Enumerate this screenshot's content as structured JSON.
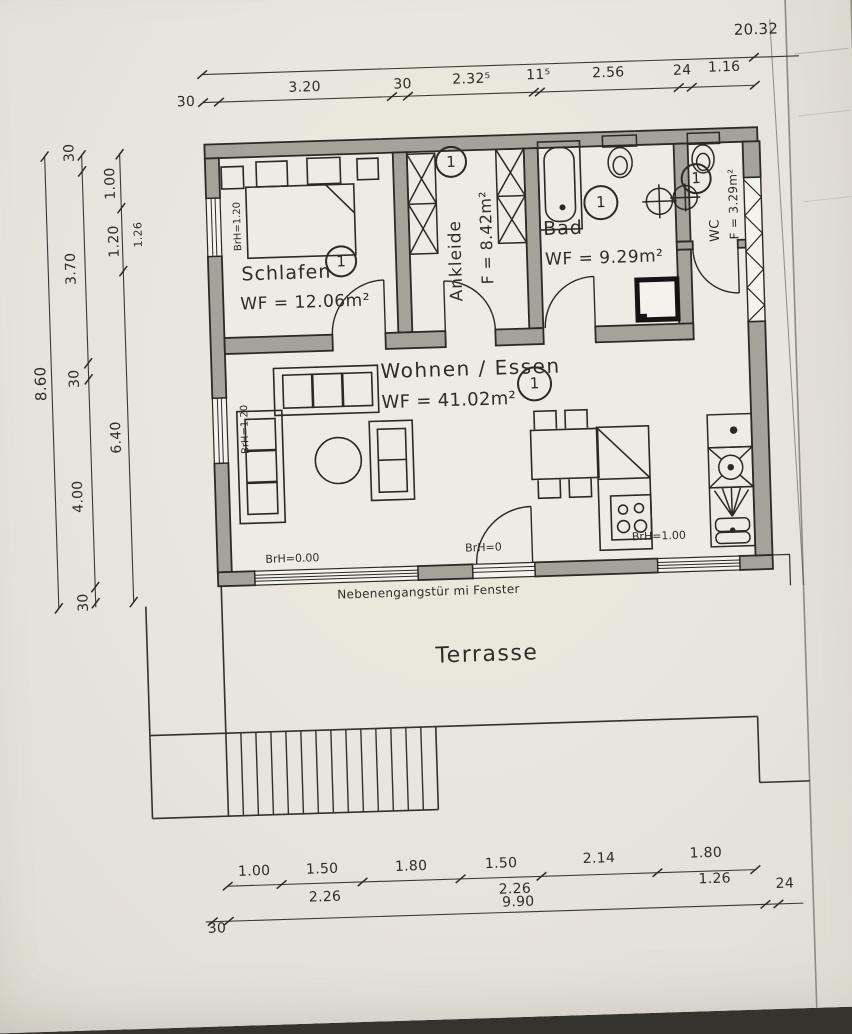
{
  "rooms": {
    "schlafen": {
      "name": "Schlafen",
      "badge": "1",
      "area": "WF = 12.06m²"
    },
    "ankleide": {
      "name": "Ankleide",
      "badge": "1",
      "area": "F = 8.42m²"
    },
    "bad": {
      "name": "Bad",
      "badge": "1",
      "area": "WF = 9.29m²"
    },
    "wc": {
      "name": "WC",
      "badge": "1",
      "area": "F = 3.29m²"
    },
    "wohnen": {
      "name": "Wohnen / Essen",
      "badge": "1",
      "area": "WF = 41.02m²"
    },
    "terrasse": {
      "name": "Terrasse"
    }
  },
  "annotations": {
    "door_note": "Nebenengangstür mi Fenster",
    "brh_schlafen_window": "BrH=1.20",
    "brh_wohnen_window": "BrH=1.20",
    "brh_terrace_window": "BrH=0.00",
    "brh_terrace_door": "BrH=0",
    "brh_kitchen_window": "BrH=1.00"
  },
  "dimensions": {
    "top_total": "20.32",
    "top": [
      "30",
      "3.20",
      "30",
      "2.32⁵",
      "11⁵",
      "2.56",
      "24",
      "1.16"
    ],
    "left_total": "8.60",
    "left_outer": [
      "30",
      "3.70",
      "30",
      "4.00",
      "30"
    ],
    "left_inner": [
      "1.00",
      "1.20",
      "6.40"
    ],
    "left_wall": "1.26",
    "bottom_segments": [
      "1.00",
      "1.50",
      "1.80",
      "1.50",
      "2.14",
      "1.80"
    ],
    "bottom_sub": [
      "2.26",
      "2.26",
      "1.26"
    ],
    "bottom_total": "9.90",
    "bottom_right": "24",
    "bottom_left": "30"
  },
  "colors": {
    "wall": "#a5a29a",
    "line": "#2b2925",
    "paper": "#e9e6df"
  }
}
